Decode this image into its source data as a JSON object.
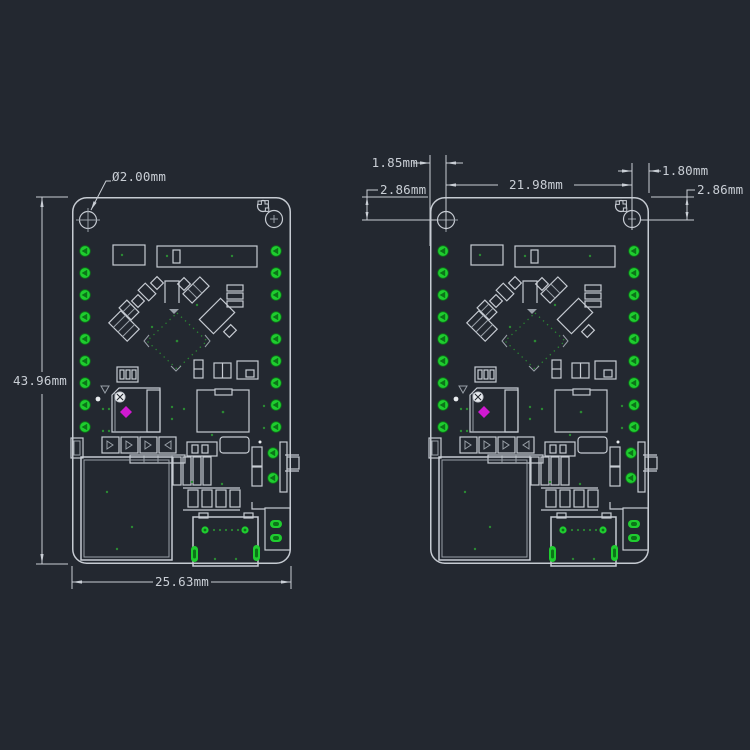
{
  "palette": {
    "background": "#232830",
    "line": "#c6cbd2",
    "line_dim": "#99a0a8",
    "text": "#c9ced5",
    "pad_green": "#1fcd2f",
    "pad_green_dark": "#0b7418",
    "via_green": "#2b8a33",
    "magenta": "#d119d1",
    "white": "#e8ebee"
  },
  "drawing": {
    "type": "pcb-mechanical-drawing",
    "unit": "mm",
    "left_view": {
      "hole_diameter_label": "Ø2.00mm",
      "board_height_label": "43.96mm",
      "board_width_label": "25.63mm"
    },
    "right_view": {
      "hole_left_offset_label": "1.85mm",
      "hole_top_offset_left_label": "2.86mm",
      "hole_spacing_label": "21.98mm",
      "hole_right_offset_label": "1.80mm",
      "hole_top_offset_right_label": "2.86mm"
    }
  }
}
